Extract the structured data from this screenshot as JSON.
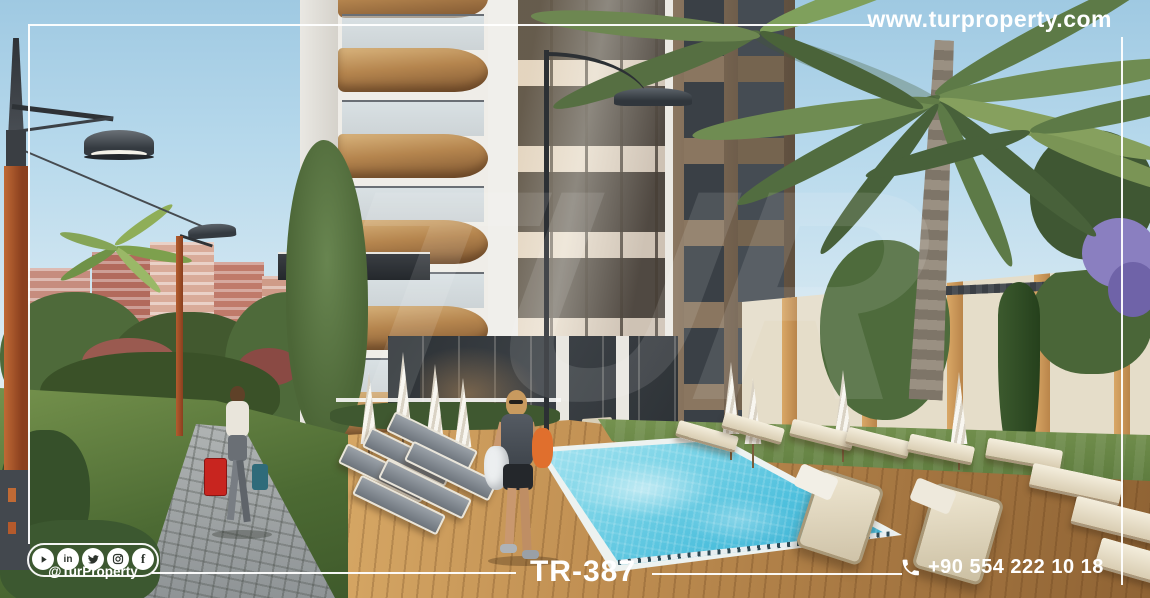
{
  "branding": {
    "website": "www.turproperty.com",
    "social_handle": "@TurProperty",
    "social_platforms": [
      "YouTube",
      "LinkedIn",
      "Twitter",
      "Instagram",
      "Facebook"
    ],
    "watermark": "TUR"
  },
  "listing": {
    "code": "TR-387",
    "phone": "+90 554 222 10 18"
  },
  "icons": {
    "phone": "phone-icon",
    "youtube": "youtube-icon",
    "linkedin": "linkedin-icon",
    "twitter": "twitter-icon",
    "instagram": "instagram-icon",
    "facebook": "facebook-icon"
  },
  "palette": {
    "overlay_white": "#ffffff",
    "sky_blue": "#aed2e7",
    "building_white": "#f0efeb",
    "balcony_wood": "#b5854e",
    "pool_water": "#55c4de",
    "deck_wood": "#bb8950",
    "grass_green": "#5e7c40",
    "wall_cream": "#e5ddc9",
    "palm_green": "#5d7a47",
    "lamp_orange": "#a85a2e",
    "city_pink": "#c2847a"
  }
}
